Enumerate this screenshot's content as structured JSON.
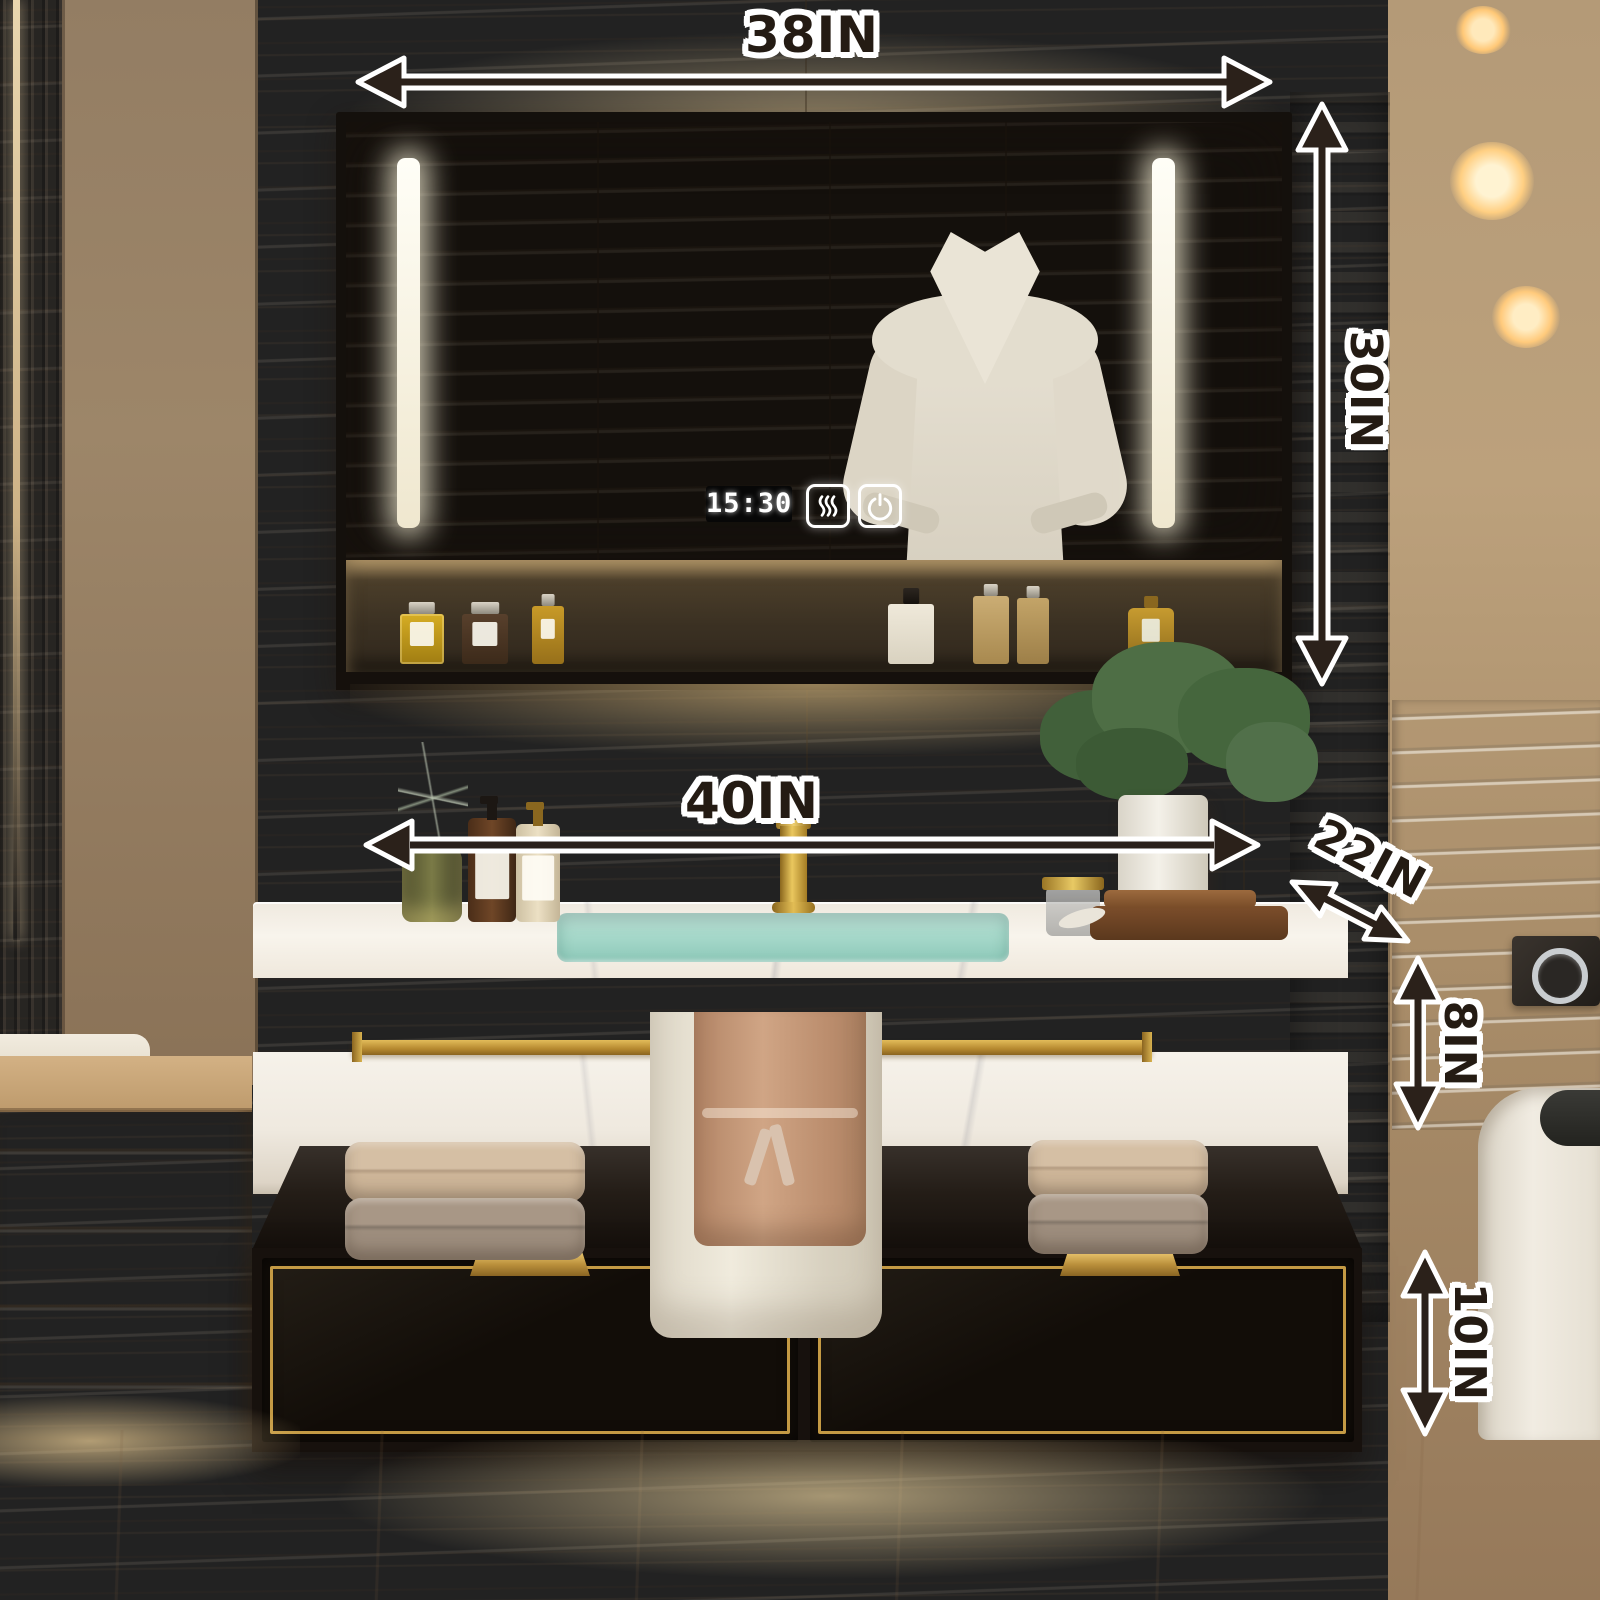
{
  "annotations": {
    "top_width": "38IN",
    "cabinet_height": "30IN",
    "vanity_width": "40IN",
    "vanity_depth": "22IN",
    "countertop_height": "8IN",
    "drawer_cabinet_height": "10IN"
  },
  "mirror_cabinet": {
    "clock_time": "15:30",
    "icons": [
      "defogger-icon",
      "power-icon"
    ]
  },
  "colors": {
    "annotation_ink": "#241b13",
    "annotation_outline": "#ffffff",
    "gold_accent": "#c49a44",
    "sink_water": "#9fd3c3",
    "cabinet_black": "#17110d",
    "led_white": "#fdfbf2",
    "wall_wood": "#9b8468"
  }
}
